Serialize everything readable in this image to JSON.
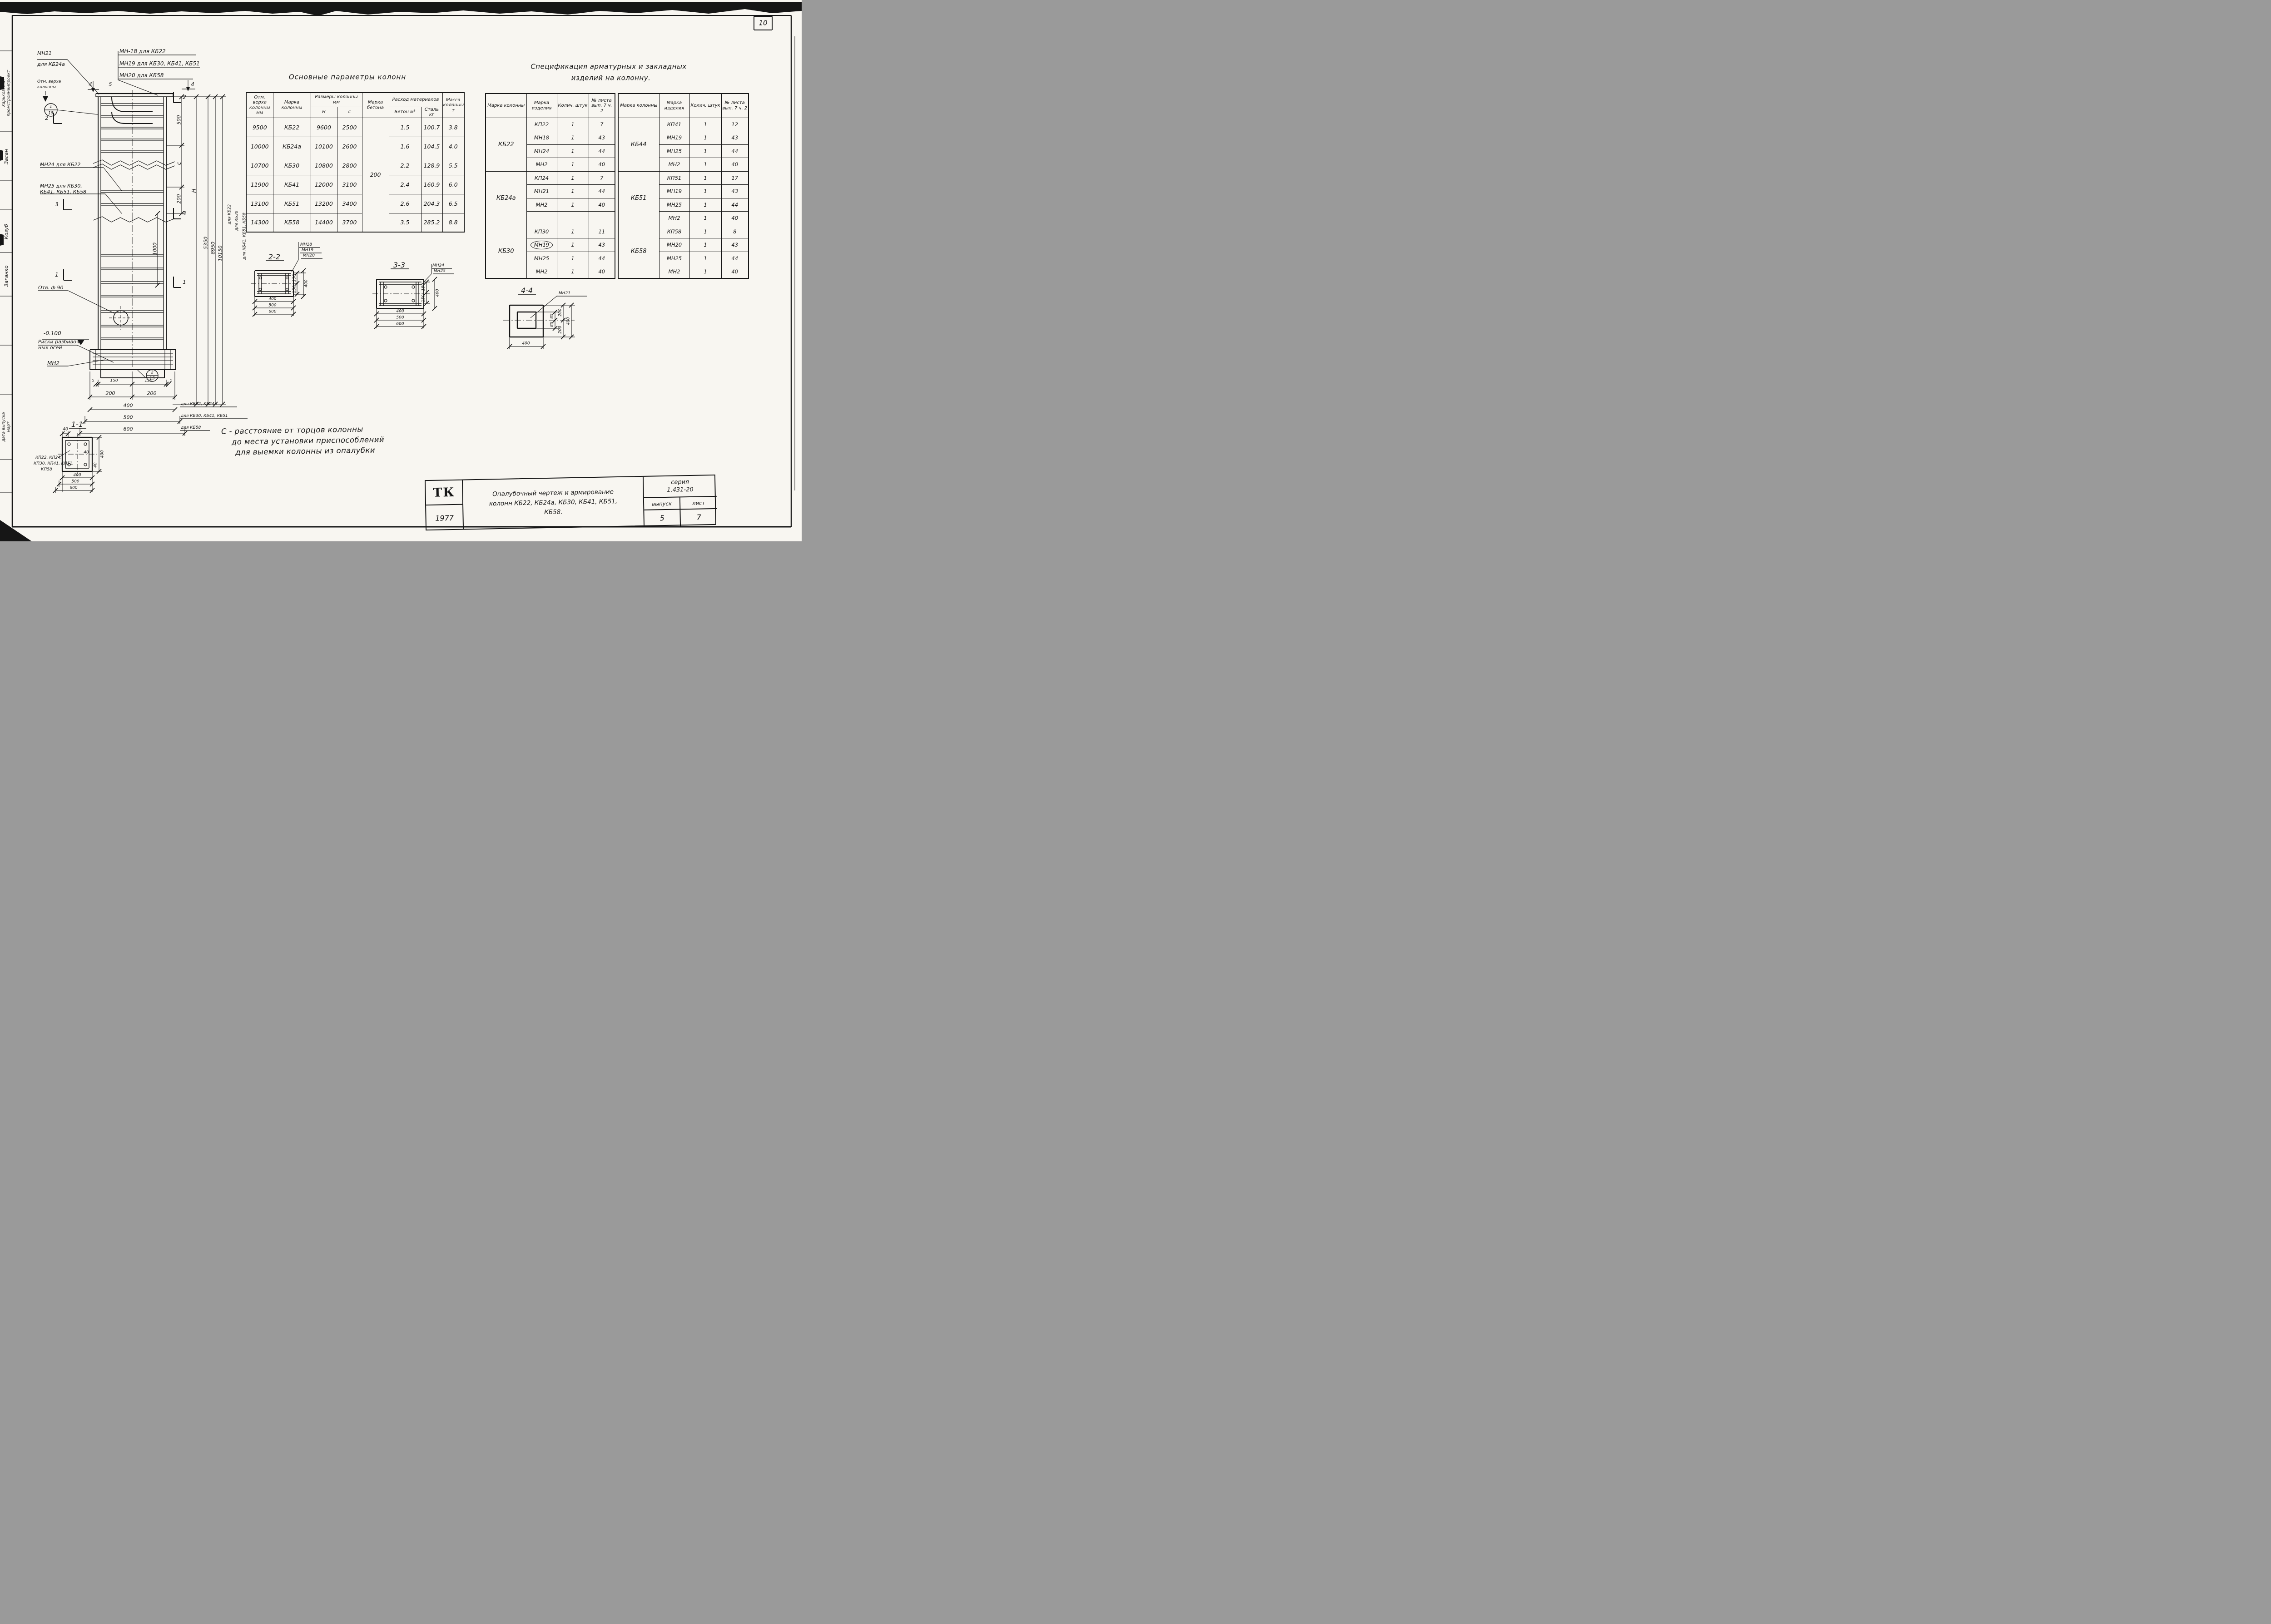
{
  "colors": {
    "paper": "#f8f6f1",
    "ink": "#161616"
  },
  "sheet": {
    "number": "10"
  },
  "stamp": {
    "org1": "Харьковский",
    "org2": "промстройниипроект",
    "sig": "Засан",
    "name1": "Козуб",
    "name2": "Заганко",
    "footer1": "дата выпуска",
    "footer2": "март"
  },
  "el": {
    "mn21": "МН21",
    "mn21b": "для КБ24а",
    "mn18": "МН-18 для КБ22",
    "mn19": "МН19 для КБ30, КБ41, КБ51",
    "mn20": "МН20 для КБ58",
    "otm1": "Отм. верха",
    "otm2": "колонны",
    "n4l": "4",
    "n5": "5",
    "n4r": "4",
    "c1t": "1",
    "c1b": "15",
    "c2t": "2",
    "c2b": "15",
    "s2": "2",
    "s3": "3",
    "s1": "1",
    "mn24": "МН24 для КБ22",
    "mn25a": "МН25 для КБ30,",
    "mn25b": "КБ41, КБ51, КБ58",
    "otv": "Отв. ф 90",
    "rsk1": "Риски разбивоч-",
    "rsk2": "ных осей",
    "lvl": "-0.100",
    "mn2": "МН2",
    "d500": "500",
    "dc": "с",
    "d200": "200",
    "d1000": "1000",
    "dH": "Н",
    "d5350": "5350",
    "d8950": "8950",
    "d10150": "10150",
    "r22": "для КБ22",
    "r30": "для КБ30",
    "r41": "для КБ41, КБ51, КБ58",
    "b5a": "5",
    "b150a": "150",
    "b150b": "150",
    "b5b": "5",
    "b200a": "200",
    "b200b": "200",
    "b400": "400",
    "b500": "500",
    "b600": "600",
    "f22": "для КБ22, КБ24а",
    "f30": "для КБ30, КБ41, КБ51",
    "f58": "для КБ58"
  },
  "params": {
    "title": "Основные параметры колонн",
    "h_otm": "Отм. верха колонны мм",
    "h_marka": "Марка колонны",
    "h_razm": "Размеры колонны мм",
    "h_H": "Н",
    "h_c": "с",
    "h_beton": "Марка бетона",
    "h_rashod": "Расход материалов",
    "h_beton2": "Бетон м³",
    "h_stal": "Сталь кг",
    "h_massa": "Масса колонны т",
    "beton_value": "200",
    "rows": [
      [
        "9500",
        "КБ22",
        "9600",
        "2500",
        "1.5",
        "100.7",
        "3.8"
      ],
      [
        "10000",
        "КБ24а",
        "10100",
        "2600",
        "1.6",
        "104.5",
        "4.0"
      ],
      [
        "10700",
        "КБ30",
        "10800",
        "2800",
        "2.2",
        "128.9",
        "5.5"
      ],
      [
        "11900",
        "КБ41",
        "12000",
        "3100",
        "2.4",
        "160.9",
        "6.0"
      ],
      [
        "13100",
        "КБ51",
        "13200",
        "3400",
        "2.6",
        "204.3",
        "6.5"
      ],
      [
        "14300",
        "КБ58",
        "14400",
        "3700",
        "3.5",
        "285.2",
        "8.8"
      ]
    ]
  },
  "spec": {
    "title1": "Спецификация арматурных и закладных",
    "title2": "изделий на колонну.",
    "h_col": "Марка колонны",
    "h_item": "Марка изделия",
    "h_qty": "Колич. штук",
    "h_sheet": "№ листа вып. 7 ч. 2",
    "left": [
      {
        "group": "КБ22",
        "items": [
          [
            "КП22",
            "1",
            "7"
          ],
          [
            "МН18",
            "1",
            "43"
          ],
          [
            "МН24",
            "1",
            "44"
          ],
          [
            "МН2",
            "1",
            "40"
          ]
        ]
      },
      {
        "group": "КБ24а",
        "items": [
          [
            "КП24",
            "1",
            "7"
          ],
          [
            "МН21",
            "1",
            "44"
          ],
          [
            "МН2",
            "1",
            "40"
          ],
          [
            "",
            "",
            ""
          ]
        ]
      },
      {
        "group": "КБ30",
        "circled": "МН19",
        "items": [
          [
            "КП30",
            "1",
            "11"
          ],
          [
            "МН19",
            "1",
            "43"
          ],
          [
            "МН25",
            "1",
            "44"
          ],
          [
            "МН2",
            "1",
            "40"
          ]
        ]
      }
    ],
    "right": [
      {
        "group": "КБ44",
        "items": [
          [
            "КП41",
            "1",
            "12"
          ],
          [
            "МН19",
            "1",
            "43"
          ],
          [
            "МН25",
            "1",
            "44"
          ],
          [
            "МН2",
            "1",
            "40"
          ]
        ]
      },
      {
        "group": "КБ51",
        "items": [
          [
            "КП51",
            "1",
            "17"
          ],
          [
            "МН19",
            "1",
            "43"
          ],
          [
            "МН25",
            "1",
            "44"
          ],
          [
            "МН2",
            "1",
            "40"
          ]
        ]
      },
      {
        "group": "КБ58",
        "items": [
          [
            "КП58",
            "1",
            "8"
          ],
          [
            "МН20",
            "1",
            "43"
          ],
          [
            "МН25",
            "1",
            "44"
          ],
          [
            "МН2",
            "1",
            "40"
          ]
        ]
      }
    ]
  },
  "sec": {
    "t22": "2-2",
    "t33": "3-3",
    "t44": "4-4",
    "t11": "1-1",
    "mn18": "МН18",
    "mn19": "МН19",
    "mn20": "МН20",
    "mn24": "МН24",
    "mn25": "МН25",
    "mn21": "МН21",
    "d150": "150",
    "d400": "400",
    "d500": "500",
    "d600": "600",
    "d85": "85",
    "d200": "200",
    "d40": "40",
    "lbl1": "КП22, КП24,",
    "lbl2": "КП30, КП41, КП51,",
    "lbl3": "КП58"
  },
  "note": {
    "l1": "С - расстояние от торцов колонны",
    "l2": "до места установки приспособлений",
    "l3": "для выемки колонны из опалубки"
  },
  "titleblock": {
    "logo": "ТК",
    "year": "1977",
    "t1": "Опалубочный чертеж и армирование",
    "t2": "колонн КБ22, КБ24а, КБ30, КБ41, КБ51,",
    "t3": "КБ58.",
    "series_label": "серия",
    "series": "1.431-20",
    "vypusk": "выпуск",
    "list": "лист",
    "vypusk_val": "5",
    "list_val": "7"
  }
}
